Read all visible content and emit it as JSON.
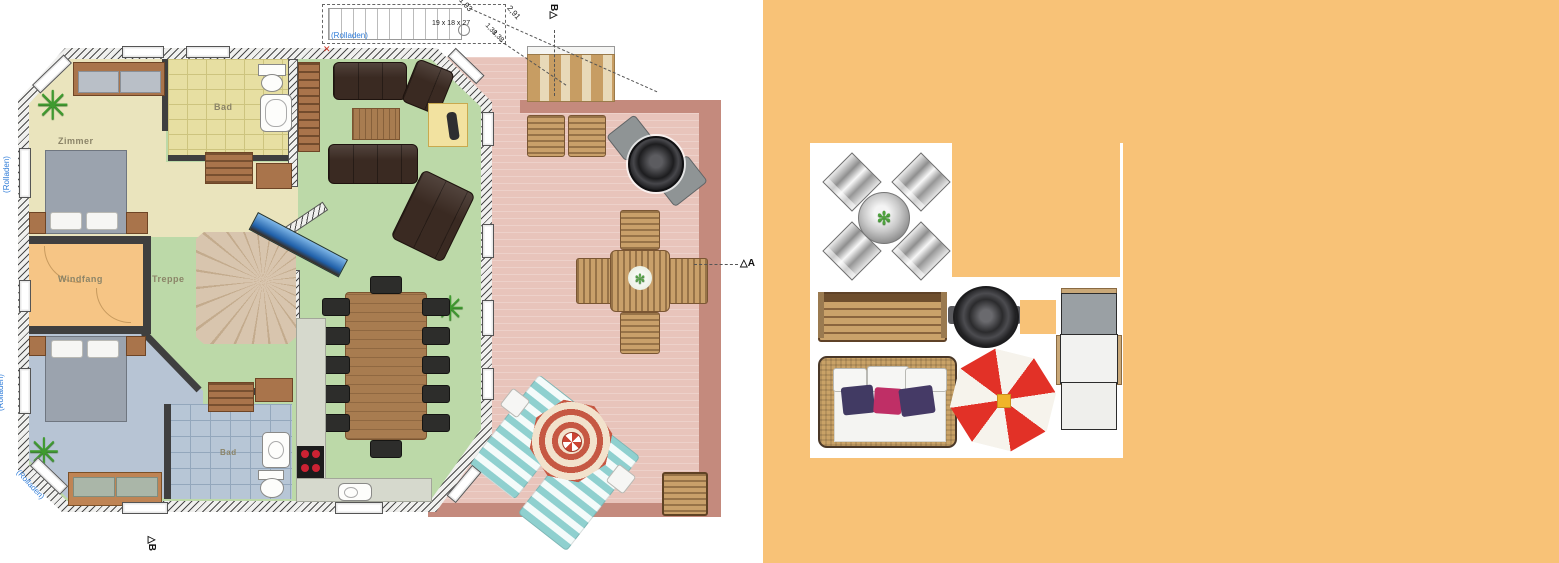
{
  "rooms": {
    "bedroom1": "Zimmer",
    "bath_top": "Bad",
    "entry": "Windfang",
    "stairs": "Treppe",
    "bath_bottom": "Bad"
  },
  "annotations": {
    "rolladen_top": "(Rolladen)",
    "rolladen_left_upper": "(Rolladen)",
    "rolladen_left_lower": "(Rolladen)",
    "rolladen_corner": "(Rolladen)",
    "stair_spec": "19 x 18 x 27",
    "dims": [
      "1,93",
      "2,91",
      "1,38",
      "1,38"
    ],
    "marker_triangle": "△",
    "marker_top_letter": "B",
    "marker_right_letter": "A",
    "marker_bottom_letter": "B",
    "red_mark": "✕"
  },
  "icons": {
    "plant_glyph": "✳",
    "flower_glyph": "✻"
  },
  "panel_items": {
    "dining_set": "patio-dining-set",
    "bench": "garden-bench",
    "grill": "round-grill",
    "swatch": "orange-swatch",
    "lounger": "sun-lounger",
    "daybed": "daybed-with-cushions",
    "parasol": "red-white-parasol"
  },
  "colors": {
    "background_right": "#f8c277",
    "panel": "#ffffff",
    "terrace": "#e8c4bb",
    "terrace_border": "#c48a7d",
    "living_floor": "#bcd9a8",
    "bedroom1_floor": "#eae4bd",
    "bath_top_floor": "#e7dfa2",
    "entry_floor": "#f6c585",
    "bedroom2_floor": "#b7c4d4",
    "bath_bottom_floor": "#b7c6d6",
    "sofa": "#3a2a22",
    "wood": "#a87c50",
    "parasol_red": "#e23127",
    "cushion_navy": "#413a63",
    "cushion_magenta": "#bf2f66",
    "cushion_purple": "#453a66",
    "label_blue": "#2f7cd8"
  }
}
